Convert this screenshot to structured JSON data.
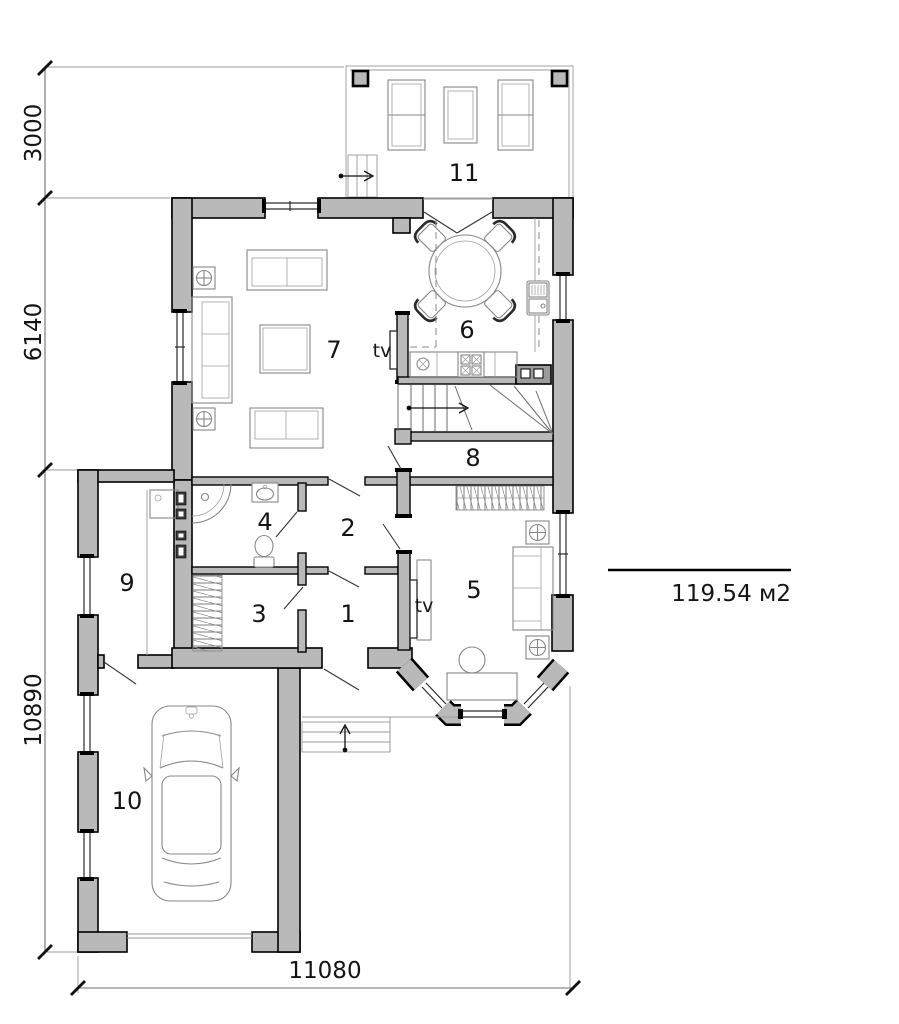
{
  "dimensions": {
    "left_top": "3000",
    "left_middle": "6140",
    "left_bottom": "10890",
    "bottom_width": "11080"
  },
  "area_note": {
    "value": "119.54 м2"
  },
  "rooms": {
    "r1": "1",
    "r2": "2",
    "r3": "3",
    "r4": "4",
    "r5": "5",
    "r6": "6",
    "r7": "7",
    "r8": "8",
    "r9": "9",
    "r10": "10",
    "r11": "11"
  },
  "labels": {
    "tv_living": "tv",
    "tv_bedroom": "tv"
  }
}
